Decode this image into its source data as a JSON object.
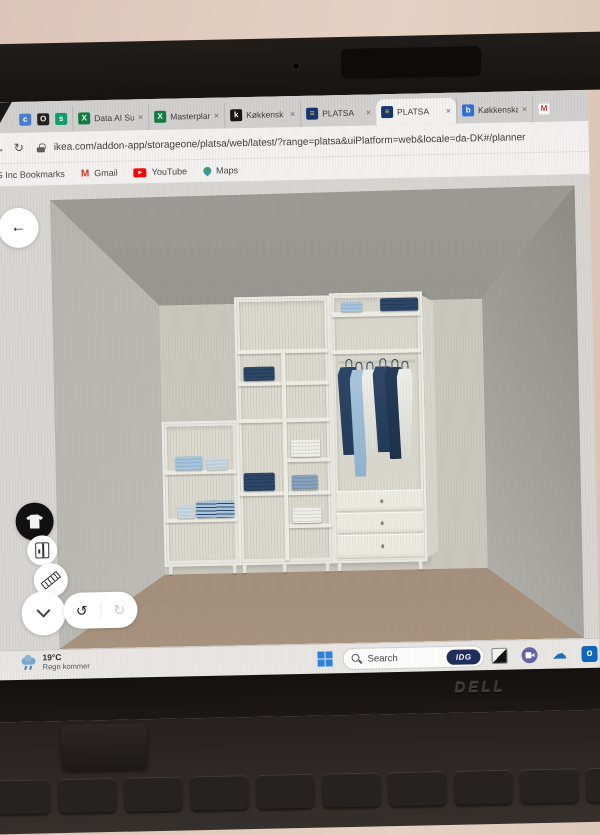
{
  "window": {
    "brand": "DELL"
  },
  "browser": {
    "pinned_tabs": [
      {
        "glyph": "c",
        "bg": "#4a7fd0",
        "fg": "#ffffff"
      },
      {
        "glyph": "O",
        "bg": "#23211f",
        "fg": "#eeeeee"
      },
      {
        "glyph": "s",
        "bg": "#0d9e6e",
        "fg": "#ffffff"
      }
    ],
    "tabs": [
      {
        "label": "Data AI Su",
        "icon_glyph": "X",
        "icon_bg": "#107c41",
        "icon_fg": "#ffffff",
        "active": false,
        "partial": false
      },
      {
        "label": "Masterplan",
        "icon_glyph": "X",
        "icon_bg": "#107c41",
        "icon_fg": "#ffffff",
        "active": false,
        "partial": false
      },
      {
        "label": "Køkkensk",
        "icon_glyph": "k",
        "icon_bg": "#141414",
        "icon_fg": "#ffffff",
        "active": false,
        "partial": false
      },
      {
        "label": "PLATSA",
        "icon_glyph": "≡",
        "icon_bg": "#16356e",
        "icon_fg": "#f5cf3d",
        "active": false,
        "partial": false
      },
      {
        "label": "PLATSA",
        "icon_glyph": "≡",
        "icon_bg": "#16356e",
        "icon_fg": "#f5cf3d",
        "active": true,
        "partial": false
      },
      {
        "label": "Køkkenska",
        "icon_glyph": "b",
        "icon_bg": "#2f6fd6",
        "icon_fg": "#ffffff",
        "active": false,
        "partial": false
      },
      {
        "label": "",
        "icon_glyph": "M",
        "icon_bg": "#ffffff",
        "icon_fg": "#d93025",
        "active": false,
        "partial": true
      }
    ],
    "nav": {
      "forward": "→",
      "reload": "↻"
    },
    "url": "ikea.com/addon-app/storageone/platsa/web/latest/?range=platsa&uiPlatform=web&locale=da-DK#/planner",
    "bookmarks": [
      {
        "label": "DG Inc Bookmarks",
        "icon": "none"
      },
      {
        "label": "Gmail",
        "icon": "gmail"
      },
      {
        "label": "YouTube",
        "icon": "youtube"
      },
      {
        "label": "Maps",
        "icon": "maps"
      }
    ]
  },
  "planner": {
    "undo_glyph": "↺",
    "redo_glyph": "↻",
    "back_glyph": "←"
  },
  "taskbar": {
    "weather_temp": "19°C",
    "weather_desc": "Regn kommer",
    "search_placeholder": "Search",
    "search_badge": "IDG",
    "apps": [
      "app-window",
      "teams",
      "onedrive",
      "outlook"
    ]
  },
  "scene": {
    "room": {
      "bg": "#d7d6d2",
      "ceiling_top": "#9c9b95",
      "ceiling_bottom": "#8b8a84",
      "wall_back": "#cbc9c0",
      "wall_left_near": "#c9c8c2",
      "wall_left_far": "#b4b3ad",
      "wall_right_near": "#c4c3bd",
      "wall_right_far": "#8f8e88",
      "floor_near": "#a8937f",
      "floor_far": "#8f7c6c"
    },
    "cloth": {
      "navy": [
        "#2e4767",
        "#223a58"
      ],
      "navy2": [
        "#253c5a",
        "#1d3049"
      ],
      "lightblue": [
        "#a9c6dd",
        "#8fb3cf"
      ],
      "pale": [
        "#ccd8e2",
        "#b9c9d6"
      ],
      "whitecloth": [
        "#eff0ea",
        "#d8d9d1"
      ],
      "denim": [
        "#8aa3bc",
        "#738fa9"
      ],
      "stripes": [
        "#a9c6dd",
        "#2e4767"
      ]
    },
    "items": [
      {
        "n": "left-unit",
        "k": "frame",
        "x": 127,
        "y": 238,
        "w": 76,
        "h": 145
      },
      {
        "n": "left-unit-interior",
        "k": "interior",
        "x": 132,
        "y": 243,
        "w": 66,
        "h": 134
      },
      {
        "n": "mid-unit",
        "k": "frame",
        "x": 202,
        "y": 115,
        "w": 95,
        "h": 268
      },
      {
        "n": "mid-unit-interior",
        "k": "interior",
        "x": 207,
        "y": 120,
        "w": 85,
        "h": 257
      },
      {
        "n": "right-unit",
        "k": "frame",
        "x": 297,
        "y": 113,
        "w": 93,
        "h": 270
      },
      {
        "n": "right-unit-interior",
        "k": "interior",
        "x": 302,
        "y": 118,
        "w": 83,
        "h": 259
      },
      {
        "n": "right-unit-side-panel",
        "k": "side",
        "x": 390,
        "y": 117,
        "w": 11,
        "h": 262
      },
      {
        "n": "shelf",
        "k": "shelf",
        "x": 129,
        "y": 287,
        "w": 72,
        "h": 4
      },
      {
        "n": "shelf",
        "k": "shelf",
        "x": 129,
        "y": 335,
        "w": 72,
        "h": 4
      },
      {
        "n": "shelf",
        "k": "shelf",
        "x": 204,
        "y": 168,
        "w": 91,
        "h": 4
      },
      {
        "n": "shelf",
        "k": "shelf",
        "x": 204,
        "y": 200,
        "w": 91,
        "h": 4
      },
      {
        "n": "shelf",
        "k": "shelf",
        "x": 204,
        "y": 237,
        "w": 91,
        "h": 4
      },
      {
        "n": "shelf",
        "k": "shelf",
        "x": 252,
        "y": 277,
        "w": 43,
        "h": 4
      },
      {
        "n": "shelf",
        "k": "shelf",
        "x": 204,
        "y": 310,
        "w": 91,
        "h": 4
      },
      {
        "n": "shelf",
        "k": "shelf",
        "x": 252,
        "y": 343,
        "w": 43,
        "h": 4
      },
      {
        "n": "divider",
        "k": "shelf",
        "x": 248,
        "y": 168,
        "w": 4,
        "h": 211
      },
      {
        "n": "shelf",
        "k": "shelf",
        "x": 299,
        "y": 132,
        "w": 89,
        "h": 5
      },
      {
        "n": "shelf",
        "k": "shelf",
        "x": 299,
        "y": 170,
        "w": 89,
        "h": 4
      },
      {
        "n": "clothes-rail",
        "k": "rail",
        "x": 305,
        "y": 181,
        "w": 77,
        "h": 3
      },
      {
        "n": "drawer",
        "k": "drawer",
        "x": 300,
        "y": 311,
        "w": 87,
        "h": 21
      },
      {
        "n": "drawer",
        "k": "drawer",
        "x": 300,
        "y": 333,
        "w": 87,
        "h": 21
      },
      {
        "n": "drawer",
        "k": "drawer",
        "x": 300,
        "y": 355,
        "w": 87,
        "h": 24
      },
      {
        "n": "drawer-knob",
        "k": "knob",
        "x": 344,
        "y": 320,
        "w": 3,
        "h": 4
      },
      {
        "n": "drawer-knob",
        "k": "knob",
        "x": 344,
        "y": 342,
        "w": 3,
        "h": 4
      },
      {
        "n": "drawer-knob",
        "k": "knob",
        "x": 344,
        "y": 365,
        "w": 3,
        "h": 4
      },
      {
        "n": "leg",
        "k": "leg",
        "x": 131,
        "y": 383,
        "w": 4,
        "h": 8
      },
      {
        "n": "leg",
        "k": "leg",
        "x": 195,
        "y": 383,
        "w": 4,
        "h": 8
      },
      {
        "n": "leg",
        "k": "leg",
        "x": 205,
        "y": 383,
        "w": 4,
        "h": 8
      },
      {
        "n": "leg",
        "k": "leg",
        "x": 245,
        "y": 383,
        "w": 4,
        "h": 8
      },
      {
        "n": "leg",
        "k": "leg",
        "x": 288,
        "y": 383,
        "w": 4,
        "h": 8
      },
      {
        "n": "leg",
        "k": "leg",
        "x": 300,
        "y": 383,
        "w": 4,
        "h": 8
      },
      {
        "n": "leg",
        "k": "leg",
        "x": 381,
        "y": 383,
        "w": 4,
        "h": 8
      },
      {
        "n": "folded-stack",
        "k": "stack",
        "x": 140,
        "y": 273,
        "w": 27,
        "h": 14,
        "c": "lightblue"
      },
      {
        "n": "folded-stack",
        "k": "stack",
        "x": 171,
        "y": 275,
        "w": 21,
        "h": 12,
        "c": "pale"
      },
      {
        "n": "folded-stack",
        "k": "stack",
        "x": 141,
        "y": 322,
        "w": 18,
        "h": 13,
        "c": "pale"
      },
      {
        "n": "folded-stack",
        "k": "stack",
        "x": 160,
        "y": 318,
        "w": 38,
        "h": 17,
        "c": "stripes"
      },
      {
        "n": "folded-stack",
        "k": "stack",
        "x": 210,
        "y": 185,
        "w": 31,
        "h": 14,
        "c": "navy"
      },
      {
        "n": "folded-stack",
        "k": "stack",
        "x": 256,
        "y": 259,
        "w": 29,
        "h": 17,
        "c": "whitecloth"
      },
      {
        "n": "folded-stack",
        "k": "stack",
        "x": 208,
        "y": 291,
        "w": 31,
        "h": 18,
        "c": "navy"
      },
      {
        "n": "folded-stack",
        "k": "stack",
        "x": 256,
        "y": 294,
        "w": 26,
        "h": 15,
        "c": "denim"
      },
      {
        "n": "folded-stack",
        "k": "stack",
        "x": 256,
        "y": 327,
        "w": 29,
        "h": 15,
        "c": "whitecloth"
      },
      {
        "n": "folded-stack",
        "k": "stack",
        "x": 309,
        "y": 122,
        "w": 21,
        "h": 10,
        "c": "lightblue"
      },
      {
        "n": "folded-stack",
        "k": "stack",
        "x": 348,
        "y": 119,
        "w": 38,
        "h": 13,
        "c": "navy"
      },
      {
        "n": "hanging-shirt",
        "k": "shirt",
        "x": 304,
        "y": 187,
        "w": 21,
        "h": 88,
        "c": "navy"
      },
      {
        "n": "hanging-shirt",
        "k": "shirt",
        "x": 316,
        "y": 190,
        "w": 18,
        "h": 107,
        "c": "lightblue"
      },
      {
        "n": "hanging-shirt",
        "k": "shirt",
        "x": 328,
        "y": 190,
        "w": 15,
        "h": 87,
        "c": "whitecloth"
      },
      {
        "n": "hanging-shirt",
        "k": "shirt",
        "x": 339,
        "y": 187,
        "w": 20,
        "h": 86,
        "c": "navy"
      },
      {
        "n": "hanging-shirt",
        "k": "shirt",
        "x": 351,
        "y": 188,
        "w": 19,
        "h": 92,
        "c": "navy2"
      },
      {
        "n": "hanging-shirt",
        "k": "shirt",
        "x": 363,
        "y": 190,
        "w": 16,
        "h": 93,
        "c": "whitecloth"
      }
    ]
  }
}
